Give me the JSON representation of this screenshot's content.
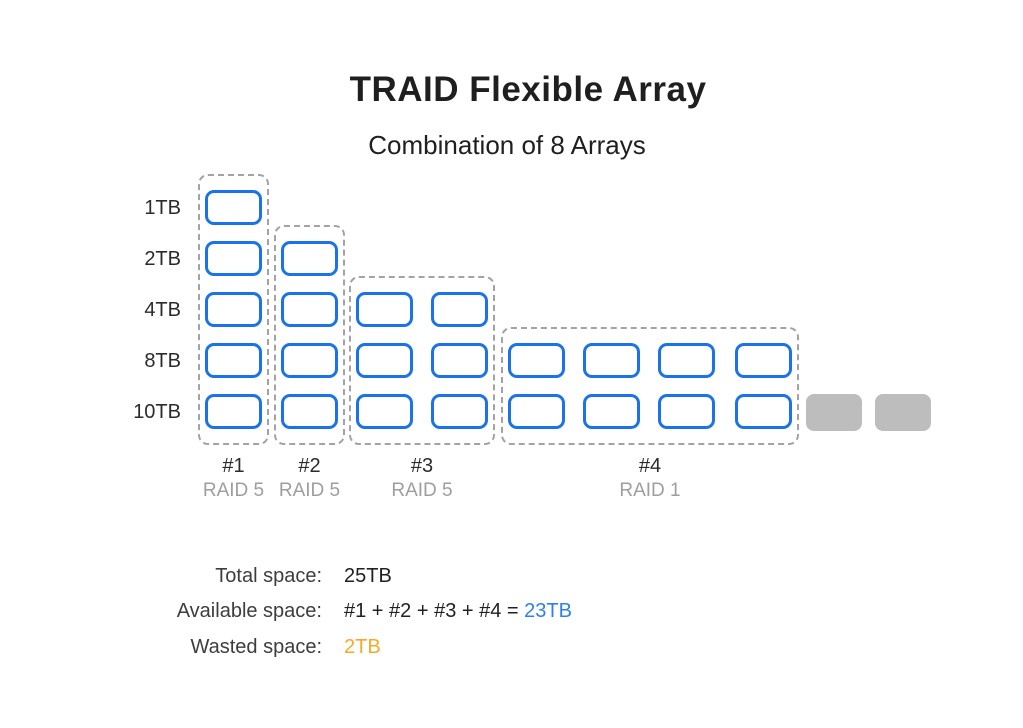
{
  "page": {
    "title": "TRAID Flexible Array",
    "subtitle": "Combination of 8 Arrays"
  },
  "colors": {
    "disk_border": "#1a73e8",
    "disk_fill": "#ffffff",
    "wasted_fill": "#bdbdbd",
    "group_dash": "#a3a3a3",
    "text_dark": "#212121",
    "text_gray": "#9e9e9e",
    "available_value": "#2d7ff2",
    "wasted_value": "#f9a825"
  },
  "diagram": {
    "row_labels": [
      "1TB",
      "2TB",
      "4TB",
      "8TB",
      "10TB"
    ],
    "groups": [
      {
        "id": "#1",
        "raid": "RAID 5",
        "rows": [
          0,
          1,
          2,
          3,
          4
        ],
        "cols": [
          0
        ]
      },
      {
        "id": "#2",
        "raid": "RAID 5",
        "rows": [
          1,
          2,
          3,
          4
        ],
        "cols": [
          1
        ]
      },
      {
        "id": "#3",
        "raid": "RAID 5",
        "rows": [
          2,
          3,
          4
        ],
        "cols": [
          2,
          3
        ]
      },
      {
        "id": "#4",
        "raid": "RAID 1",
        "rows": [
          3,
          4
        ],
        "cols": [
          4,
          5,
          6,
          7
        ]
      }
    ],
    "wasted_blocks": [
      {
        "row_label": "10TB"
      },
      {
        "row_label": "10TB"
      }
    ]
  },
  "stats": [
    {
      "label": "Total space:",
      "prefix": "",
      "value": "25TB",
      "value_color": "dark"
    },
    {
      "label": "Available space:",
      "prefix": "#1 + #2 + #3 + #4 = ",
      "value": "23TB",
      "value_color": "available"
    },
    {
      "label": "Wasted space:",
      "prefix": "",
      "value": "2TB",
      "value_color": "wasted"
    }
  ]
}
